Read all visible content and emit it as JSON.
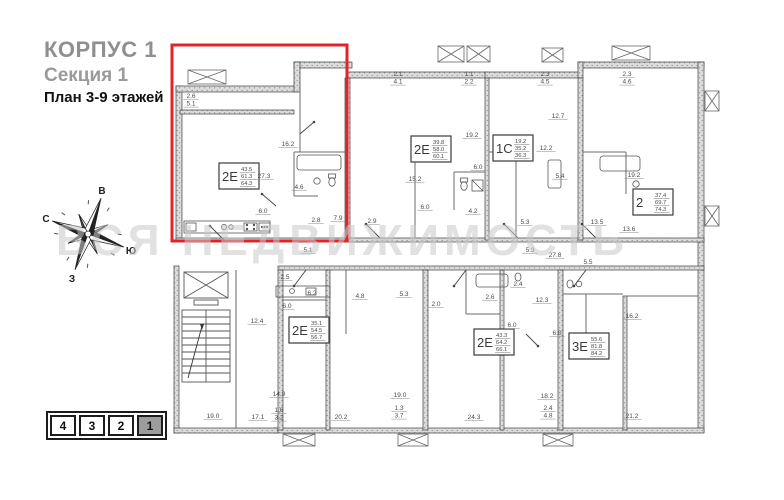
{
  "header": {
    "building": "КОРПУС 1",
    "section": "Секция 1",
    "plan_label": "План 3-9 этажей"
  },
  "watermark": "ВСЯ НЕДВИЖИМОСТЬ",
  "compass": {
    "top": "В",
    "left": "С",
    "right": "Ю",
    "bottom": "З"
  },
  "floor_selector": [
    {
      "label": "4",
      "active": false
    },
    {
      "label": "3",
      "active": false
    },
    {
      "label": "2",
      "active": false
    },
    {
      "label": "1",
      "active": true
    }
  ],
  "colors": {
    "highlight_red": "#e2232a",
    "title_gray": "#8f8f8f",
    "wall_line": "#3f3f3f",
    "label_text": "#4a4a4a",
    "active_tab_bg": "#9c9c9c",
    "watermark_gray": "#c9c9c9"
  },
  "plan": {
    "apartments": [
      {
        "id": "a1",
        "type": "2Е",
        "areas": [
          "43.5",
          "61.3",
          "64.3"
        ],
        "x": 53,
        "y": 129,
        "highlighted": true
      },
      {
        "id": "a2",
        "type": "2Е",
        "areas": [
          "39.8",
          "58.0",
          "60.1"
        ],
        "x": 245,
        "y": 102,
        "highlighted": false
      },
      {
        "id": "a3",
        "type": "1С",
        "areas": [
          "19.2",
          "35.2",
          "36.3"
        ],
        "x": 327,
        "y": 101,
        "highlighted": false
      },
      {
        "id": "a4",
        "type": "2",
        "areas": [
          "37.4",
          "69.7",
          "74.3"
        ],
        "x": 467,
        "y": 155,
        "highlighted": false
      },
      {
        "id": "a5",
        "type": "2Е",
        "areas": [
          "35.1",
          "54.5",
          "56.7"
        ],
        "x": 123,
        "y": 283,
        "highlighted": false
      },
      {
        "id": "a6",
        "type": "2Е",
        "areas": [
          "43.3",
          "64.2",
          "66.1"
        ],
        "x": 308,
        "y": 295,
        "highlighted": false
      },
      {
        "id": "a7",
        "type": "3Е",
        "areas": [
          "55.6",
          "81.8",
          "84.2"
        ],
        "x": 403,
        "y": 299,
        "highlighted": false
      }
    ],
    "room_labels": [
      {
        "t": "2.6",
        "t2": "5.1",
        "x": 25,
        "y": 64
      },
      {
        "t": "27.3",
        "x": 98,
        "y": 144
      },
      {
        "t": "16.2",
        "x": 122,
        "y": 112
      },
      {
        "t": "4.6",
        "x": 133,
        "y": 155
      },
      {
        "t": "6.0",
        "x": 97,
        "y": 179
      },
      {
        "t": "2.8",
        "x": 150,
        "y": 188
      },
      {
        "t": "7.9",
        "x": 172,
        "y": 186
      },
      {
        "t": "2.1",
        "t2": "4.1",
        "x": 232,
        "y": 42
      },
      {
        "t": "1.1",
        "t2": "2.2",
        "x": 303,
        "y": 42
      },
      {
        "t": "2.3",
        "t2": "4.5",
        "x": 379,
        "y": 42
      },
      {
        "t": "2.3",
        "t2": "4.6",
        "x": 461,
        "y": 42
      },
      {
        "t": "19.2",
        "x": 306,
        "y": 103
      },
      {
        "t": "15.2",
        "x": 249,
        "y": 147
      },
      {
        "t": "6.0",
        "x": 312,
        "y": 135
      },
      {
        "t": "6.0",
        "x": 259,
        "y": 175
      },
      {
        "t": "4.2",
        "x": 307,
        "y": 179
      },
      {
        "t": "2.9",
        "x": 206,
        "y": 189
      },
      {
        "t": "12.2",
        "x": 380,
        "y": 116
      },
      {
        "t": "12.7",
        "x": 392,
        "y": 84
      },
      {
        "t": "5.4",
        "x": 394,
        "y": 144
      },
      {
        "t": "5.3",
        "x": 359,
        "y": 190
      },
      {
        "t": "19.2",
        "x": 468,
        "y": 143
      },
      {
        "t": "13.5",
        "x": 431,
        "y": 190
      },
      {
        "t": "13.6",
        "x": 463,
        "y": 197
      },
      {
        "t": "5.1",
        "x": 142,
        "y": 218
      },
      {
        "t": "5.3",
        "x": 364,
        "y": 218
      },
      {
        "t": "27.8",
        "x": 389,
        "y": 223
      },
      {
        "t": "12.4",
        "x": 91,
        "y": 289
      },
      {
        "t": "2.5",
        "x": 119,
        "y": 245
      },
      {
        "t": "6.2",
        "x": 146,
        "y": 261
      },
      {
        "t": "6.0",
        "x": 121,
        "y": 274
      },
      {
        "t": "4.8",
        "x": 194,
        "y": 264
      },
      {
        "t": "5.3",
        "x": 238,
        "y": 262
      },
      {
        "t": "2.0",
        "x": 270,
        "y": 272
      },
      {
        "t": "14.9",
        "x": 113,
        "y": 362
      },
      {
        "t": "1.6",
        "t2": "3.2",
        "x": 113,
        "y": 378
      },
      {
        "t": "20.2",
        "x": 175,
        "y": 385
      },
      {
        "t": "19.0",
        "x": 47,
        "y": 384
      },
      {
        "t": "17.1",
        "x": 92,
        "y": 385
      },
      {
        "t": "2.6",
        "x": 324,
        "y": 265
      },
      {
        "t": "2.4",
        "x": 352,
        "y": 252
      },
      {
        "t": "12.3",
        "x": 376,
        "y": 268
      },
      {
        "t": "6.0",
        "x": 346,
        "y": 293
      },
      {
        "t": "19.0",
        "x": 234,
        "y": 363
      },
      {
        "t": "1.3",
        "t2": "3.7",
        "x": 233,
        "y": 376
      },
      {
        "t": "24.3",
        "x": 308,
        "y": 385
      },
      {
        "t": "5.5",
        "x": 422,
        "y": 230
      },
      {
        "t": "6.0",
        "x": 391,
        "y": 301
      },
      {
        "t": "16.2",
        "x": 466,
        "y": 284
      },
      {
        "t": "18.2",
        "x": 381,
        "y": 364
      },
      {
        "t": "2.4",
        "t2": "4.8",
        "x": 382,
        "y": 376
      },
      {
        "t": "21.2",
        "x": 466,
        "y": 384
      }
    ]
  }
}
